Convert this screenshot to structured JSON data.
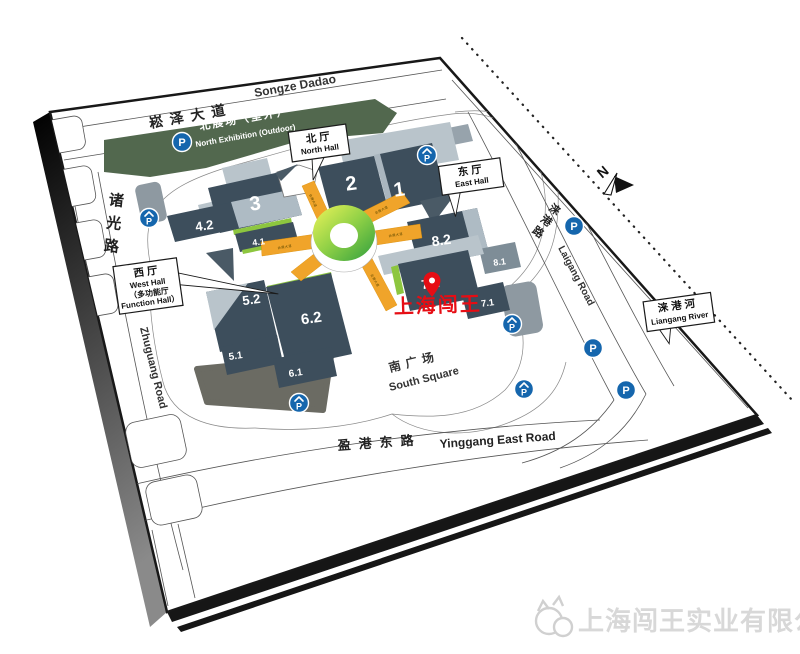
{
  "roads": {
    "songze_cn": "崧泽大道",
    "songze_en": "Songze Dadao",
    "zhuguang_cn": "诸光路",
    "zhuguang_en": "Zhuguang Road",
    "yinggang_cn": "盈港东路",
    "yinggang_en": "Yinggang East Road",
    "laigang_cn": "涞港路",
    "laigang_en": "Laigang Road"
  },
  "areas": {
    "north_exhibition_cn": "北展场（室外）",
    "north_exhibition_en": "North Exhibition (Outdoor)",
    "south_square_cn": "南广场",
    "south_square_en": "South Square"
  },
  "callouts": {
    "north_hall": {
      "cn": "北厅",
      "en": "North Hall"
    },
    "east_hall": {
      "cn": "东厅",
      "en": "East Hall"
    },
    "west_hall": {
      "cn": "西厅",
      "en": "West Hall",
      "sub_cn": "（多功能厅",
      "sub_en": "Function Hall）"
    },
    "liangang_river": {
      "cn": "涞港河",
      "en": "Liangang River"
    }
  },
  "halls": {
    "h1": "1",
    "h2": "2",
    "h3": "3",
    "h41": "4.1",
    "h42": "4.2",
    "h51": "5.1",
    "h52": "5.2",
    "h61": "6.1",
    "h62": "6.2",
    "h71": "7.1",
    "h72": "7.2",
    "h81": "8.1",
    "h82": "8.2"
  },
  "corridor_label": "会展大道",
  "compass": {
    "label": "N"
  },
  "parking": {
    "letter": "P"
  },
  "watermark": {
    "text": "上海闯王"
  },
  "footer": {
    "company_name": "上海闯王实业有限公司"
  },
  "colors": {
    "hall_dark": "#3d4e5c",
    "hall_roof_light": "#b9c4cb",
    "outdoor_green": "#52684e",
    "ring_green": "#3fae49",
    "corridor_orange": "#f0a42a",
    "accent_green": "#8dc63f",
    "parking_blue": "#1566ad",
    "watermark_red": "#e60d14",
    "footer_gray": "#d8d8d8"
  }
}
